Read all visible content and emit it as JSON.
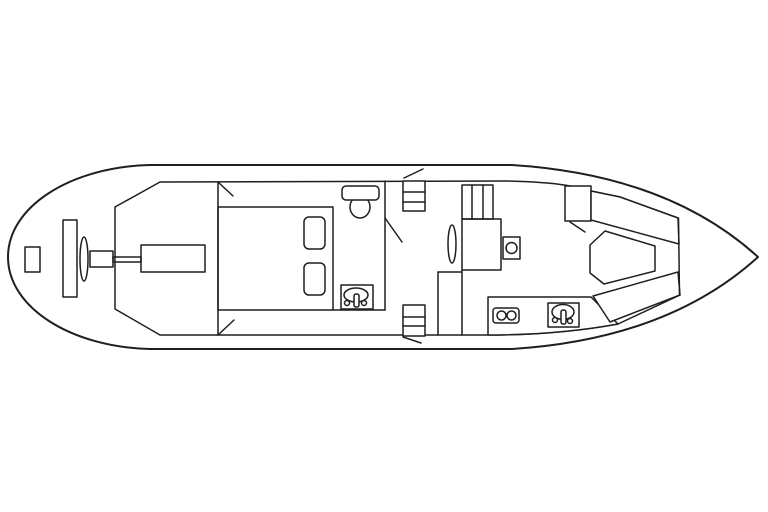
{
  "drawing": {
    "title_semantic": "boat-deck-plan",
    "canvas": {
      "width": 768,
      "height": 512,
      "background": "#ffffff",
      "stroke": "#1f1f1f"
    },
    "elements": [
      {
        "name": "hull-outline",
        "t": "path",
        "sw": 2,
        "d": "M 150,165 L 512,165 C 622,172 702,206 758,257 C 702,308 622,342 512,349 L 150,349 C 70,347 8,307 8,257 C 8,207 70,167 150,165 Z"
      },
      {
        "name": "deck-line-top",
        "t": "path",
        "d": "M 160,182 L 508,181 C 548,182 573,185 591,191 L 620,197 L 678,218"
      },
      {
        "name": "deck-line-bottom",
        "t": "path",
        "d": "M 160,335 L 488,335 C 540,335 585,330 618,324 L 680,295"
      },
      {
        "name": "engine-room-bulkhead",
        "t": "polygon_open",
        "points": "160,182 115,207 115,309 160,335"
      },
      {
        "name": "steering-gear-box",
        "t": "rect",
        "x": 25,
        "y": 247,
        "w": 15,
        "h": 25
      },
      {
        "name": "rudder-plate",
        "t": "rect",
        "x": 63,
        "y": 220,
        "w": 14,
        "h": 77
      },
      {
        "name": "propeller",
        "t": "ellipse",
        "cx": 84,
        "cy": 259,
        "rx": 4,
        "ry": 22
      },
      {
        "name": "shaft-coupling",
        "t": "rect",
        "x": 90,
        "y": 251,
        "w": 23,
        "h": 16
      },
      {
        "name": "propeller-shaft",
        "t": "rect",
        "x": 113,
        "y": 257,
        "w": 28,
        "h": 5
      },
      {
        "name": "engine-block",
        "t": "rect",
        "x": 141,
        "y": 245,
        "w": 64,
        "h": 27
      },
      {
        "name": "aft-cabin-bulkhead",
        "t": "line",
        "x1": 218,
        "y1": 182,
        "x2": 218,
        "y2": 335
      },
      {
        "name": "door-swing-aft-cabin-top",
        "t": "line",
        "x1": 218,
        "y1": 182,
        "x2": 233,
        "y2": 196
      },
      {
        "name": "door-swing-aft-cabin-bottom",
        "t": "line",
        "x1": 218,
        "y1": 335,
        "x2": 234,
        "y2": 320
      },
      {
        "name": "double-bed",
        "t": "rect",
        "x": 218,
        "y": 207,
        "w": 115,
        "h": 103
      },
      {
        "name": "pillow-top",
        "t": "rect",
        "x": 304,
        "y": 217,
        "w": 21,
        "h": 32,
        "rx": 5
      },
      {
        "name": "pillow-bottom",
        "t": "rect",
        "x": 304,
        "y": 263,
        "w": 21,
        "h": 32,
        "rx": 5
      },
      {
        "name": "head-floor-line",
        "t": "line",
        "x1": 333,
        "y1": 310,
        "x2": 385,
        "y2": 310
      },
      {
        "name": "toilet-bowl",
        "t": "ellipse",
        "cx": 360,
        "cy": 207,
        "rx": 10,
        "ry": 11
      },
      {
        "name": "toilet-tank",
        "t": "rect",
        "x": 342,
        "y": 186,
        "w": 37,
        "h": 14,
        "rx": 4,
        "f": 1
      },
      {
        "name": "head-sink-unit",
        "t": "rect",
        "x": 341,
        "y": 285,
        "w": 32,
        "h": 24
      },
      {
        "name": "head-sink-basin",
        "t": "ellipse",
        "cx": 356,
        "cy": 295,
        "rx": 12,
        "ry": 7
      },
      {
        "name": "head-sink-faucet",
        "t": "rect",
        "x": 354,
        "y": 294,
        "w": 5,
        "h": 13,
        "rx": 2,
        "f": 1
      },
      {
        "name": "head-sink-knob-left",
        "t": "circle",
        "cx": 347,
        "cy": 303,
        "r": 2.5
      },
      {
        "name": "head-sink-knob-right",
        "t": "circle",
        "cx": 364,
        "cy": 303,
        "r": 2.5
      },
      {
        "name": "head-bulkhead",
        "t": "line",
        "x1": 385,
        "y1": 181,
        "x2": 385,
        "y2": 310
      },
      {
        "name": "door-swing-head",
        "t": "line",
        "x1": 385,
        "y1": 218,
        "x2": 402,
        "y2": 242
      },
      {
        "name": "companionway-steps-top",
        "t": "rect",
        "x": 403,
        "y": 181,
        "w": 22,
        "h": 30,
        "f": 1
      },
      {
        "name": "companionway-steps-top-tread-1",
        "t": "line",
        "x1": 403,
        "y1": 192,
        "x2": 425,
        "y2": 192
      },
      {
        "name": "companionway-steps-top-tread-2",
        "t": "line",
        "x1": 403,
        "y1": 202,
        "x2": 425,
        "y2": 202
      },
      {
        "name": "hatch-line-top",
        "t": "line",
        "x1": 404,
        "y1": 178,
        "x2": 423,
        "y2": 169
      },
      {
        "name": "companionway-steps-bottom",
        "t": "rect",
        "x": 403,
        "y": 305,
        "w": 22,
        "h": 31,
        "f": 1
      },
      {
        "name": "companionway-steps-bottom-tread-1",
        "t": "line",
        "x1": 403,
        "y1": 317,
        "x2": 425,
        "y2": 317
      },
      {
        "name": "companionway-steps-bottom-tread-2",
        "t": "line",
        "x1": 403,
        "y1": 326,
        "x2": 425,
        "y2": 326
      },
      {
        "name": "hatch-line-bottom",
        "t": "line",
        "x1": 403,
        "y1": 337,
        "x2": 421,
        "y2": 343
      },
      {
        "name": "closet-top-edge",
        "t": "line",
        "x1": 438,
        "y1": 272,
        "x2": 462,
        "y2": 272
      },
      {
        "name": "closet-left-edge",
        "t": "line",
        "x1": 438,
        "y1": 272,
        "x2": 438,
        "y2": 335
      },
      {
        "name": "saloon-bulkhead",
        "t": "line",
        "x1": 462,
        "y1": 270,
        "x2": 462,
        "y2": 335
      },
      {
        "name": "wardrobe",
        "t": "rect",
        "x": 462,
        "y": 185,
        "w": 31,
        "h": 34
      },
      {
        "name": "wardrobe-divider-1",
        "t": "line",
        "x1": 472,
        "y1": 185,
        "x2": 472,
        "y2": 219
      },
      {
        "name": "wardrobe-divider-2",
        "t": "line",
        "x1": 483,
        "y1": 185,
        "x2": 483,
        "y2": 219
      },
      {
        "name": "chart-table",
        "t": "rect",
        "x": 462,
        "y": 219,
        "w": 39,
        "h": 51
      },
      {
        "name": "mast",
        "t": "ellipse",
        "cx": 452,
        "cy": 244,
        "rx": 4,
        "ry": 19
      },
      {
        "name": "helm-console",
        "t": "rect",
        "x": 503,
        "y": 237,
        "w": 17,
        "h": 22
      },
      {
        "name": "helm-wheel",
        "t": "circle",
        "cx": 511.5,
        "cy": 248,
        "r": 5.5
      },
      {
        "name": "galley-counter",
        "t": "path",
        "f": 1,
        "d": "M 488,297 L 591,297 L 618,324 C 580,331 535,335 488,335 Z"
      },
      {
        "name": "stove",
        "t": "rect",
        "x": 493,
        "y": 308,
        "w": 26,
        "h": 15,
        "rx": 3
      },
      {
        "name": "stove-burner-left",
        "t": "circle",
        "cx": 501.5,
        "cy": 315.5,
        "r": 4.5
      },
      {
        "name": "stove-burner-right",
        "t": "circle",
        "cx": 511.5,
        "cy": 315.5,
        "r": 4.5
      },
      {
        "name": "galley-sink-unit",
        "t": "rect",
        "x": 548,
        "y": 303,
        "w": 31,
        "h": 24,
        "f": 1
      },
      {
        "name": "galley-sink-basin",
        "t": "ellipse",
        "cx": 563,
        "cy": 312,
        "rx": 11,
        "ry": 7.5
      },
      {
        "name": "galley-sink-faucet",
        "t": "rect",
        "x": 561,
        "y": 310,
        "w": 5,
        "h": 14,
        "rx": 2,
        "f": 1
      },
      {
        "name": "galley-sink-knob-left",
        "t": "circle",
        "cx": 555,
        "cy": 320,
        "r": 2.5
      },
      {
        "name": "galley-sink-knob-right",
        "t": "circle",
        "cx": 570,
        "cy": 321,
        "r": 2.5
      },
      {
        "name": "vberth-seat",
        "t": "rect",
        "x": 565,
        "y": 186,
        "w": 26,
        "h": 35,
        "f": 1
      },
      {
        "name": "vberth-seat-corner-line",
        "t": "line",
        "x1": 570,
        "y1": 222,
        "x2": 585,
        "y2": 232
      },
      {
        "name": "vberth-bench-top",
        "t": "polygon",
        "f": 1,
        "points": "591,191 620,197 678,218 679,244 591,220"
      },
      {
        "name": "vberth-bench-bottom",
        "t": "polygon",
        "f": 1,
        "points": "593,296 678,272 680,295 610,322"
      },
      {
        "name": "forepeak-bulkhead",
        "t": "line",
        "x1": 678.5,
        "y1": 218,
        "x2": 679.5,
        "y2": 295
      },
      {
        "name": "vberth-table",
        "t": "polygon",
        "f": 1,
        "points": "590,245 605,231 655,246 655,271 604,284 590,273"
      }
    ]
  }
}
